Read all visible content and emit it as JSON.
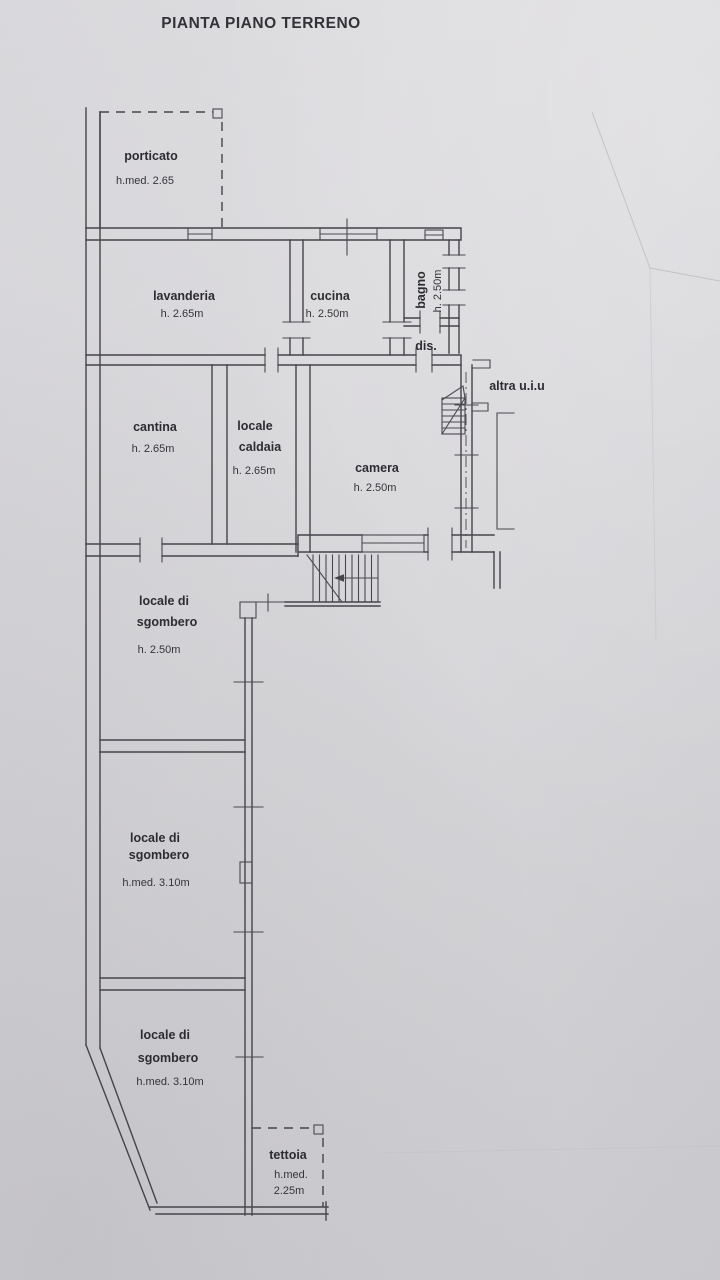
{
  "page": {
    "title": "PIANTA PIANO TERRENO"
  },
  "rooms": {
    "porticato": {
      "name": "porticato",
      "height": "h.med. 2.65"
    },
    "lavanderia": {
      "name": "lavanderia",
      "height": "h. 2.65m"
    },
    "cucina": {
      "name": "cucina",
      "height": "h. 2.50m"
    },
    "bagno": {
      "name": "bagno",
      "height": "h. 2.50m"
    },
    "dis": {
      "name": "dis."
    },
    "altra_uiu": {
      "name": "altra u.i.u"
    },
    "cantina": {
      "name": "cantina",
      "height": "h. 2.65m"
    },
    "locale_caldaia": {
      "name_line1": "locale",
      "name_line2": "caldaia",
      "height": "h. 2.65m"
    },
    "camera": {
      "name": "camera",
      "height": "h. 2.50m"
    },
    "sgombero_1": {
      "name_line1": "locale di",
      "name_line2": "sgombero",
      "height": "h. 2.50m"
    },
    "sgombero_2": {
      "name_line1": "locale di",
      "name_line2": "sgombero",
      "height": "h.med. 3.10m"
    },
    "sgombero_3": {
      "name_line1": "locale di",
      "name_line2": "sgombero",
      "height": "h.med. 3.10m"
    },
    "tettoia": {
      "name": "tettoia",
      "height_line1": "h.med.",
      "height_line2": "2.25m"
    }
  },
  "colors": {
    "paper": "#d8d7da",
    "ink": "#45444a",
    "text": "#2d2c31"
  }
}
